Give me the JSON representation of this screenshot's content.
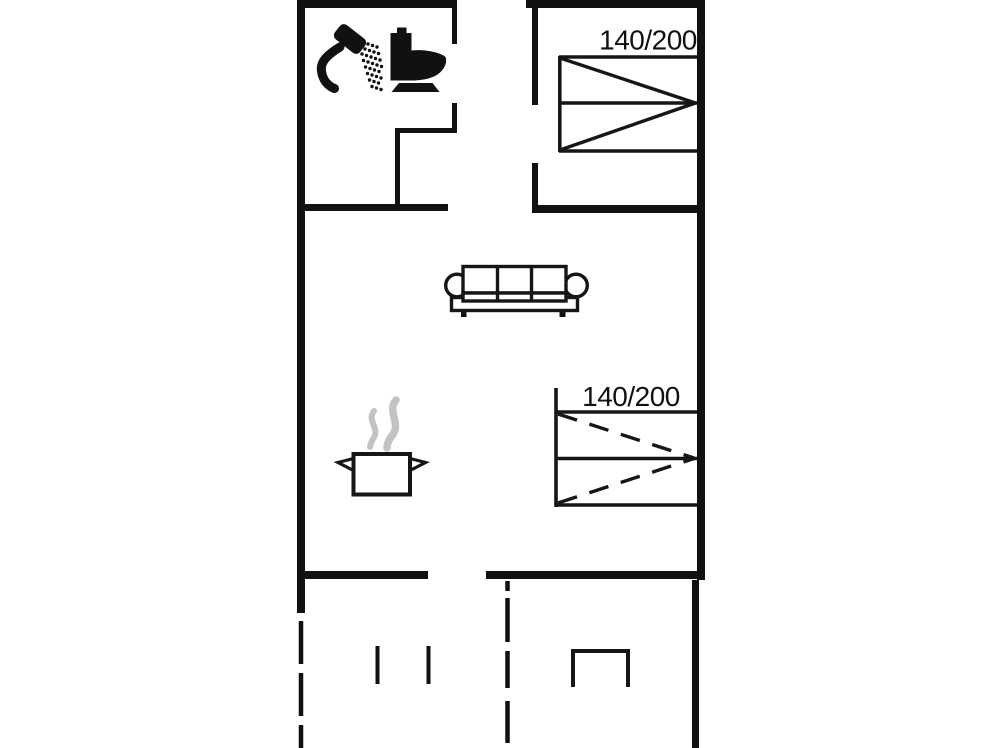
{
  "floorplan": {
    "type": "holiday-home-floor-plan",
    "colors": {
      "background": "#ffffff",
      "wall": "#111111",
      "furniture_line": "#161616",
      "steam": "#c3c3c3",
      "label_text": "#111111"
    },
    "beds": [
      {
        "id": "bed-top-bedroom",
        "label": "140/200",
        "diagonal_style": "solid"
      },
      {
        "id": "bed-living-room",
        "label": "140/200",
        "diagonal_style": "dashed"
      }
    ],
    "icons": {
      "bathroom": [
        "shower-icon",
        "toilet-icon"
      ],
      "kitchen": [
        "steam-icon",
        "cooking-pot-icon"
      ],
      "living_room": [
        "sofa-icon"
      ],
      "terrace": [
        "table-icon",
        "door-marks"
      ]
    }
  }
}
